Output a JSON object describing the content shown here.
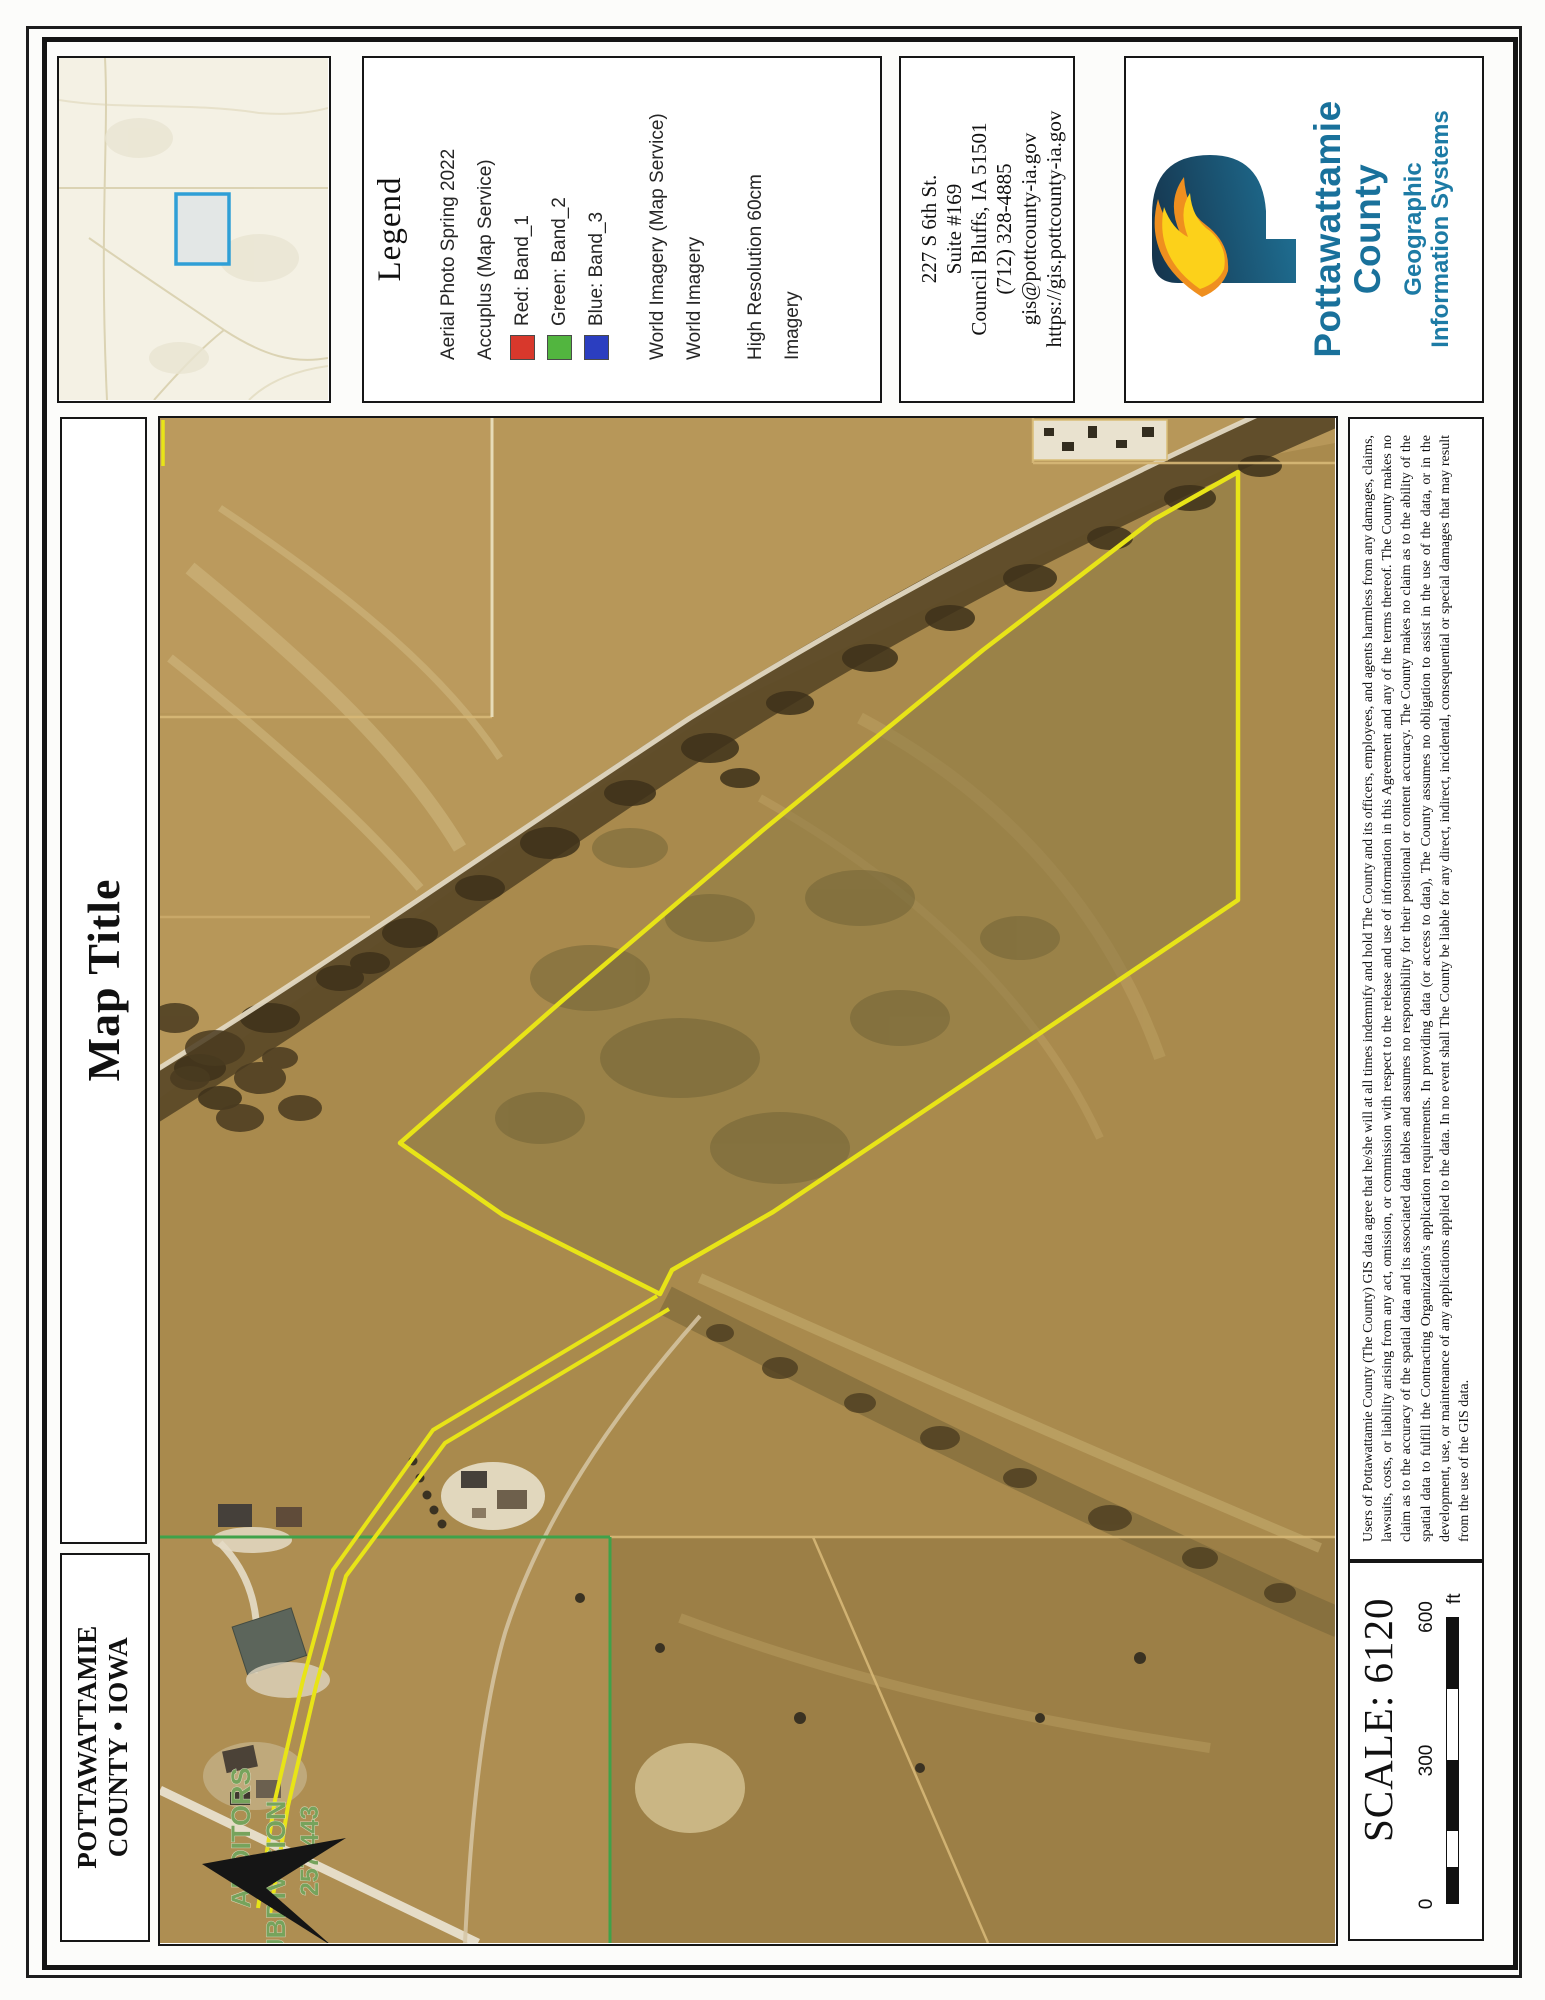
{
  "legend": {
    "title": "Legend",
    "entries": [
      {
        "text": "Aerial Photo Spring 2022"
      },
      {
        "text": "Accuplus (Map Service)"
      },
      {
        "text": "Red: Band_1",
        "swatch": "#d8382c"
      },
      {
        "text": "Green: Band_2",
        "swatch": "#52b53f"
      },
      {
        "text": "Blue: Band_3",
        "swatch": "#2b3ec0"
      },
      {
        "text": "World Imagery (Map Service)",
        "gap": true
      },
      {
        "text": "World Imagery"
      },
      {
        "text": "High Resolution 60cm",
        "gap": true
      },
      {
        "text": "Imagery"
      }
    ]
  },
  "contact": {
    "lines": [
      "227 S 6th St.",
      "Suite #169",
      "Council Bluffs, IA 51501",
      "(712) 328-4885",
      "gis@pottcounty-ia.gov",
      "https://gis.pottcounty-ia.gov"
    ],
    "date": "5/22/2024"
  },
  "logo": {
    "org_line1": "Pottawattamie",
    "org_line2": "County",
    "dept_line1": "Geographic",
    "dept_line2": "Information Systems"
  },
  "titles": {
    "map_title": "Map Title",
    "county_line1": "POTTAWATTAMIE",
    "county_line2": "COUNTY • IOWA"
  },
  "map": {
    "subdivision_label": {
      "line1": "AUDITORS",
      "line2": "SUBDIVISION",
      "ref": "257/443"
    }
  },
  "disclaimer": "Users of Pottawattamie County (The County) GIS data agree that he/she will at all times indemnify and hold The County and its officers, employees, and agents harmless from any damages, claims, lawsuits, costs, or liability arising from any act, omission, or commission with respect to the release and use of information in this Agreement and any of the terms thereof. The County makes no claim as to the accuracy of the spatial data and its associated data tables and assumes no responsibility for their positional or content accuracy. The County makes no claim as to the ability of the spatial data to fulfill the Contracting Organization's application requirements. In providing data (or access to data), The County assumes no obligation to assist in the use of the data, or in the development, use, or maintenance of any applications applied to the data. In no event shall The County be liable for any direct, indirect, incidental, consequential or special damages that may result from the use of the GIS data.",
  "scale": {
    "label": "SCALE: 6120",
    "ticks": [
      "0",
      "300",
      "600"
    ],
    "unit": "ft"
  },
  "colors": {
    "parcel_outline": "#e8e417",
    "subdivision_line": "#3fa24a",
    "subdivision_text": "#76a35c",
    "brand_teal": "#19719b",
    "inset_highlight": "#2f9fd6",
    "legend_red": "#d8382c",
    "legend_green": "#52b53f",
    "legend_blue": "#2b3ec0"
  }
}
